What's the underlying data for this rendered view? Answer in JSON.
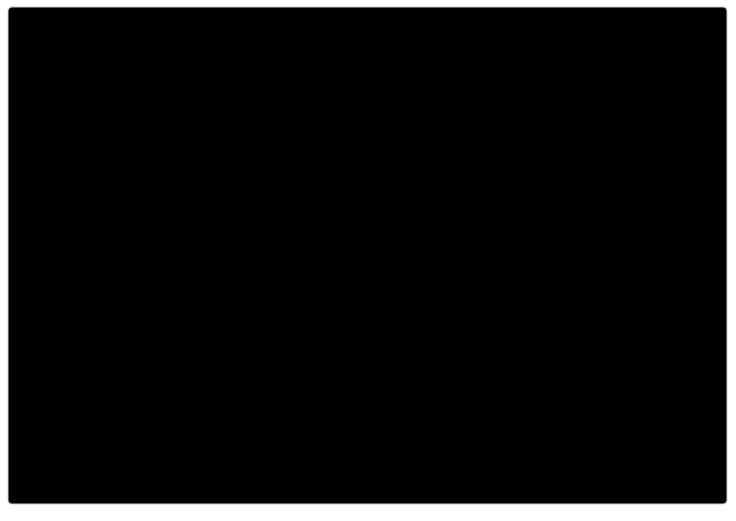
{
  "page": {
    "background": "#ffffff",
    "description": "Oblique aerial photomontage: proposed industrial estate of grey-roofed warehouse rows inside a tree belt, with village streets and houses to the west, farm fields, an existing industrial area to the east, a white office building, and a railway corridor crossing the foreground"
  },
  "photo": {
    "border_color": "#c8c8c8",
    "x": 8,
    "y": 7,
    "width": 719,
    "height": 497
  },
  "scene": {
    "regions": [
      "farm-fields",
      "village-streets",
      "village-houses",
      "orchard-woodland",
      "proposed-industrial-estate",
      "perimeter-tree-belt",
      "warehouse-rows",
      "large-warehouse-north",
      "large-warehouse-southwest",
      "existing-industrial-area",
      "greenhouse-building",
      "solar-panel-roofs",
      "white-office-building",
      "railway-corridor",
      "level-crossing",
      "ploughed-fields"
    ]
  },
  "palette": {
    "base": "#7e896c",
    "grassPale": "#97a17e",
    "grassLight": "#8d987a",
    "grassDark": "#74805f",
    "grassNE": "#6f7c5e",
    "fieldTan": "#b2a68c",
    "fieldTanLight": "#c4b79c",
    "fieldTanBig": "#c2b69b",
    "fieldBR": "#bab095",
    "plow": "#aca083",
    "furrow": "#a2967b",
    "furrowLight": "#b7ab90",
    "hedge": "#4b5640",
    "treeDark": "#46523c",
    "treeMid": "#5c6a4c",
    "cgTree1": "#6d8248",
    "cgTree2": "#86995a",
    "cgTree3": "#a3b06e",
    "cgTree4": "#55663e",
    "roadPhoto": "#a8a99d",
    "roadMinor": "#9d9f93",
    "cgRoad": "#5c6065",
    "cgGround": "#9aa37b",
    "roofLight": "#c7cdd2",
    "roofA": "#c3cad0",
    "roofStripe": "#b3bbc2",
    "roofDiv": "#9fa9b1",
    "roofShade": "#98a2aa",
    "roofAnnex": "#8f9a91",
    "entranceDark": "#76818b",
    "railBand": "#8a887b",
    "railLine": "#5a584e",
    "railRoad": "#a4a499",
    "crossing": "#b7ae9b",
    "redMark": "#b14f39",
    "houseDark": "#555249",
    "houseBrown": "#77604e",
    "houseRed": "#8a6250",
    "houseLight": "#ccc9c0",
    "houseGray": "#8d8a80",
    "garden": "#6f7c5d",
    "pool": "#4fa8a0",
    "white": "#f2f2ee",
    "officeWin": "#474747",
    "paving": "#70747a",
    "solar": "#333c45",
    "solarLine": "#4d5865",
    "ghBase": "#e3e4de",
    "ghStripe": "#3a423b",
    "shedWhite": "#eaeae5",
    "shedGray": "#c6c7c1",
    "shedGrayB": "#aeb0a8",
    "shedDark": "#6d7168",
    "shedBeige1": "#d8d1bf",
    "shedBeige2": "#d0c9b7",
    "shedBeige3": "#dcd5c3",
    "dirt": "#b1a184",
    "scrub": "#5b684c",
    "carWhite": "#e8e8e4",
    "carDark": "#3f3f3f",
    "beigeBldg": "#d9d0bb"
  }
}
